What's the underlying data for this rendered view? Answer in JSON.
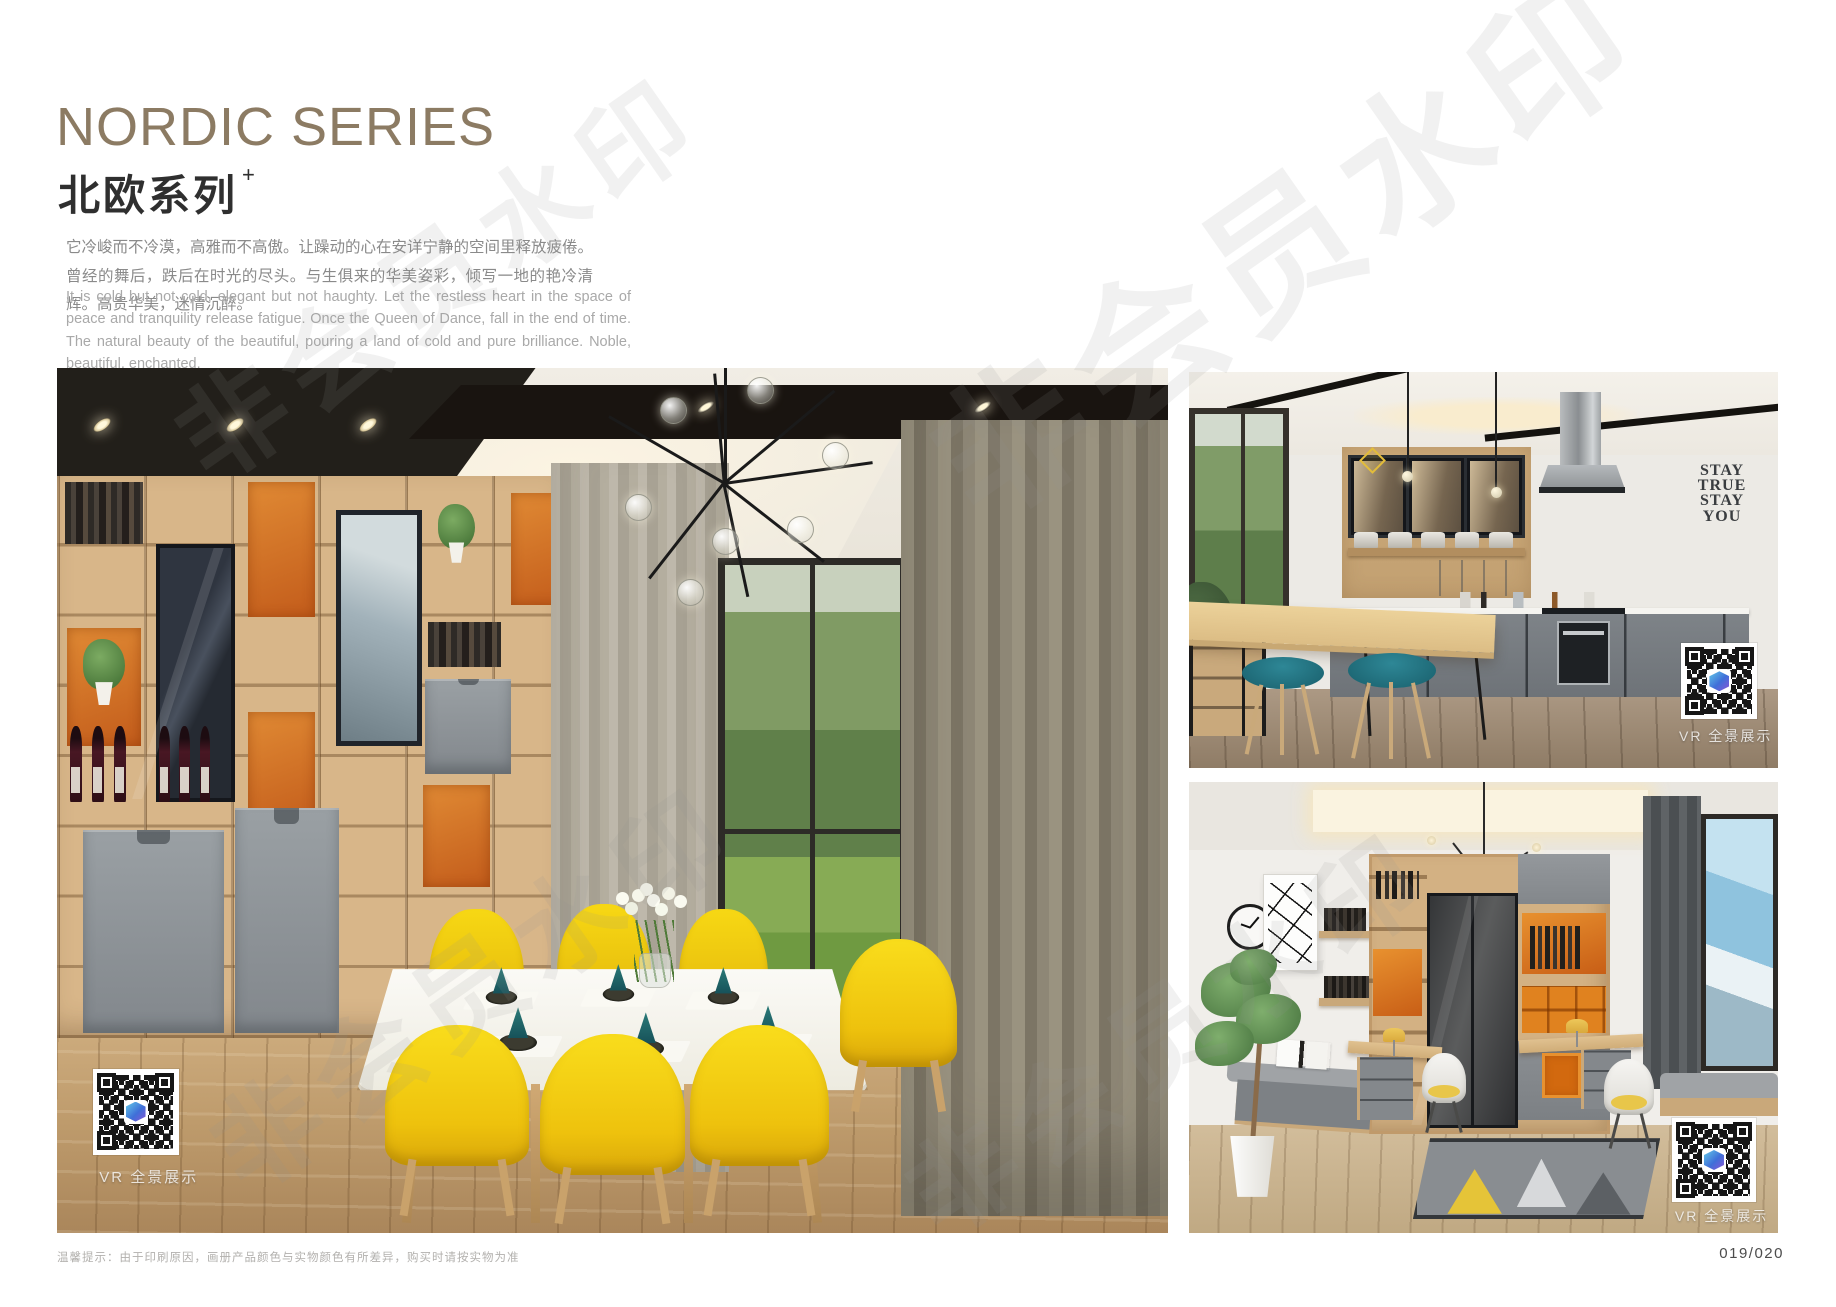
{
  "header": {
    "title_en": "NORDIC SERIES",
    "title_cn": "北欧系列",
    "title_superscript": "+",
    "intro_cn": "它冷峻而不冷漠，高雅而不高傲。让躁动的心在安详宁静的空间里释放疲倦。曾经的舞后，跌后在时光的尽头。与生俱来的华美姿彩，倾写一地的艳冷清辉。高贵华美，迷情沉醉。",
    "intro_en": "It is cold but not cold, elegant but not haughty. Let the restless heart in the space of peace and tranquility release fatigue. Once the Queen of Dance, fall in the end of time. The natural beauty of the beautiful, pouring a land of cold and pure brilliance. Noble, beautiful, enchanted."
  },
  "photos": {
    "dining": {
      "vr_label": "VR 全景展示"
    },
    "kitchen": {
      "vr_label": "VR 全景展示",
      "wall_art_lines": [
        "STAY",
        "TRUE",
        "STAY",
        "YOU"
      ]
    },
    "study": {
      "vr_label": "VR 全景展示"
    }
  },
  "footer": {
    "note": "温馨提示：由于印刷原因，画册产品颜色与实物颜色有所差异，购买时请按实物为准",
    "page_number": "019/020"
  },
  "watermark": {
    "text": "非会员水印"
  },
  "colors": {
    "title_brown": "#8c7b63",
    "accent_orange": "#d2690f",
    "chair_yellow": "#f2cf0c",
    "stool_teal": "#20798a",
    "cabinet_gray": "#8c9094",
    "wood_light": "#d8b587"
  }
}
